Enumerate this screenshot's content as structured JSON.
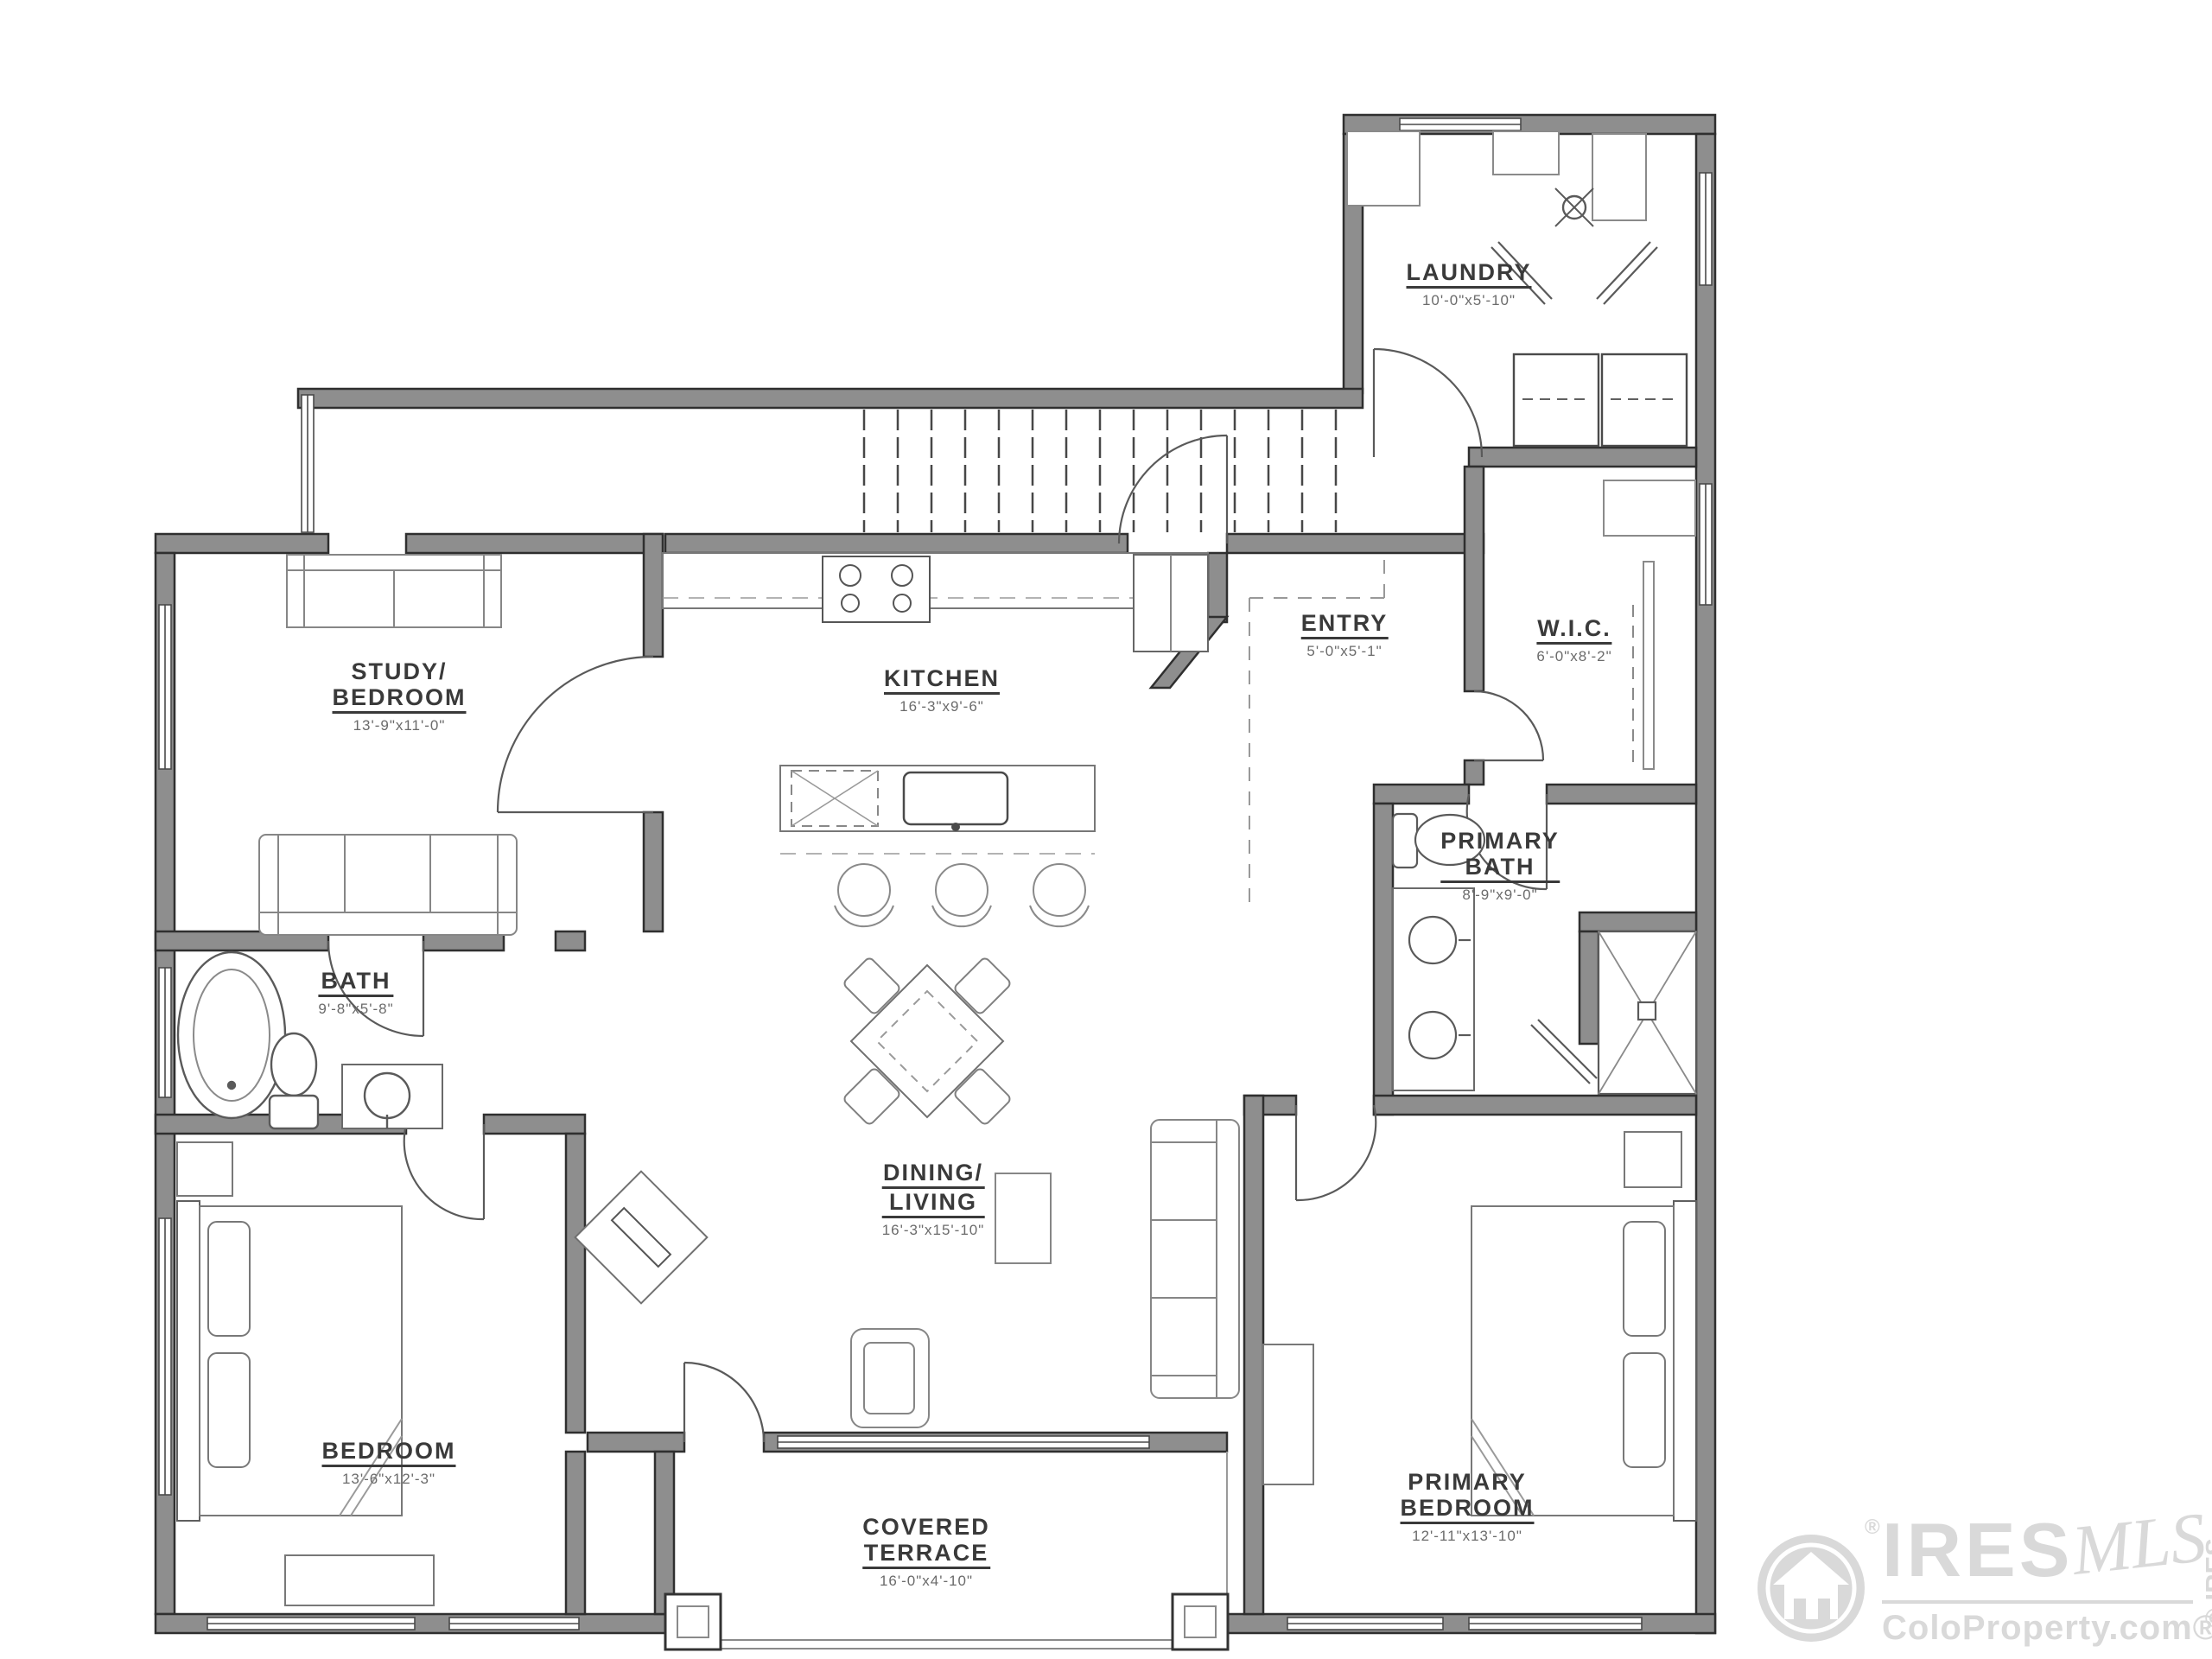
{
  "rooms": {
    "laundry": {
      "line1": "LAUNDRY",
      "dims": "10'-0\"x5'-10\""
    },
    "kitchen": {
      "line1": "KITCHEN",
      "dims": "16'-3\"x9'-6\""
    },
    "entry": {
      "line1": "ENTRY",
      "dims": "5'-0\"x5'-1\""
    },
    "wic": {
      "line1": "W.I.C.",
      "dims": "6'-0\"x8'-2\""
    },
    "study": {
      "line1": "STUDY/",
      "line2": "BEDROOM",
      "dims": "13'-9\"x11'-0\""
    },
    "bath": {
      "line1": "BATH",
      "dims": "9'-8\"x5'-8\""
    },
    "primary_bath": {
      "line1": "PRIMARY",
      "line2": "BATH",
      "dims": "8'-9\"x9'-0\""
    },
    "dining_living": {
      "line1": "DINING/",
      "line2": "LIVING",
      "dims": "16'-3\"x15'-10\""
    },
    "bedroom": {
      "line1": "BEDROOM",
      "dims": "13'-6\"x12'-3\""
    },
    "terrace": {
      "line1": "COVERED",
      "line2": "TERRACE",
      "dims": "16'-0\"x4'-10\""
    },
    "primary_bedroom": {
      "line1": "PRIMARY",
      "line2": "BEDROOM",
      "dims": "12'-11\"x13'-10\""
    }
  },
  "watermark": {
    "brand": "IRES",
    "script": "MLS",
    "site": "ColoProperty.com®",
    "registered": "®",
    "copyright": "© IRES"
  },
  "colors": {
    "wall_fill": "#8e8e8e",
    "wall_edge": "#2f2f2f",
    "label_text": "#3a3a3a",
    "watermark": "#d9d9d9"
  }
}
